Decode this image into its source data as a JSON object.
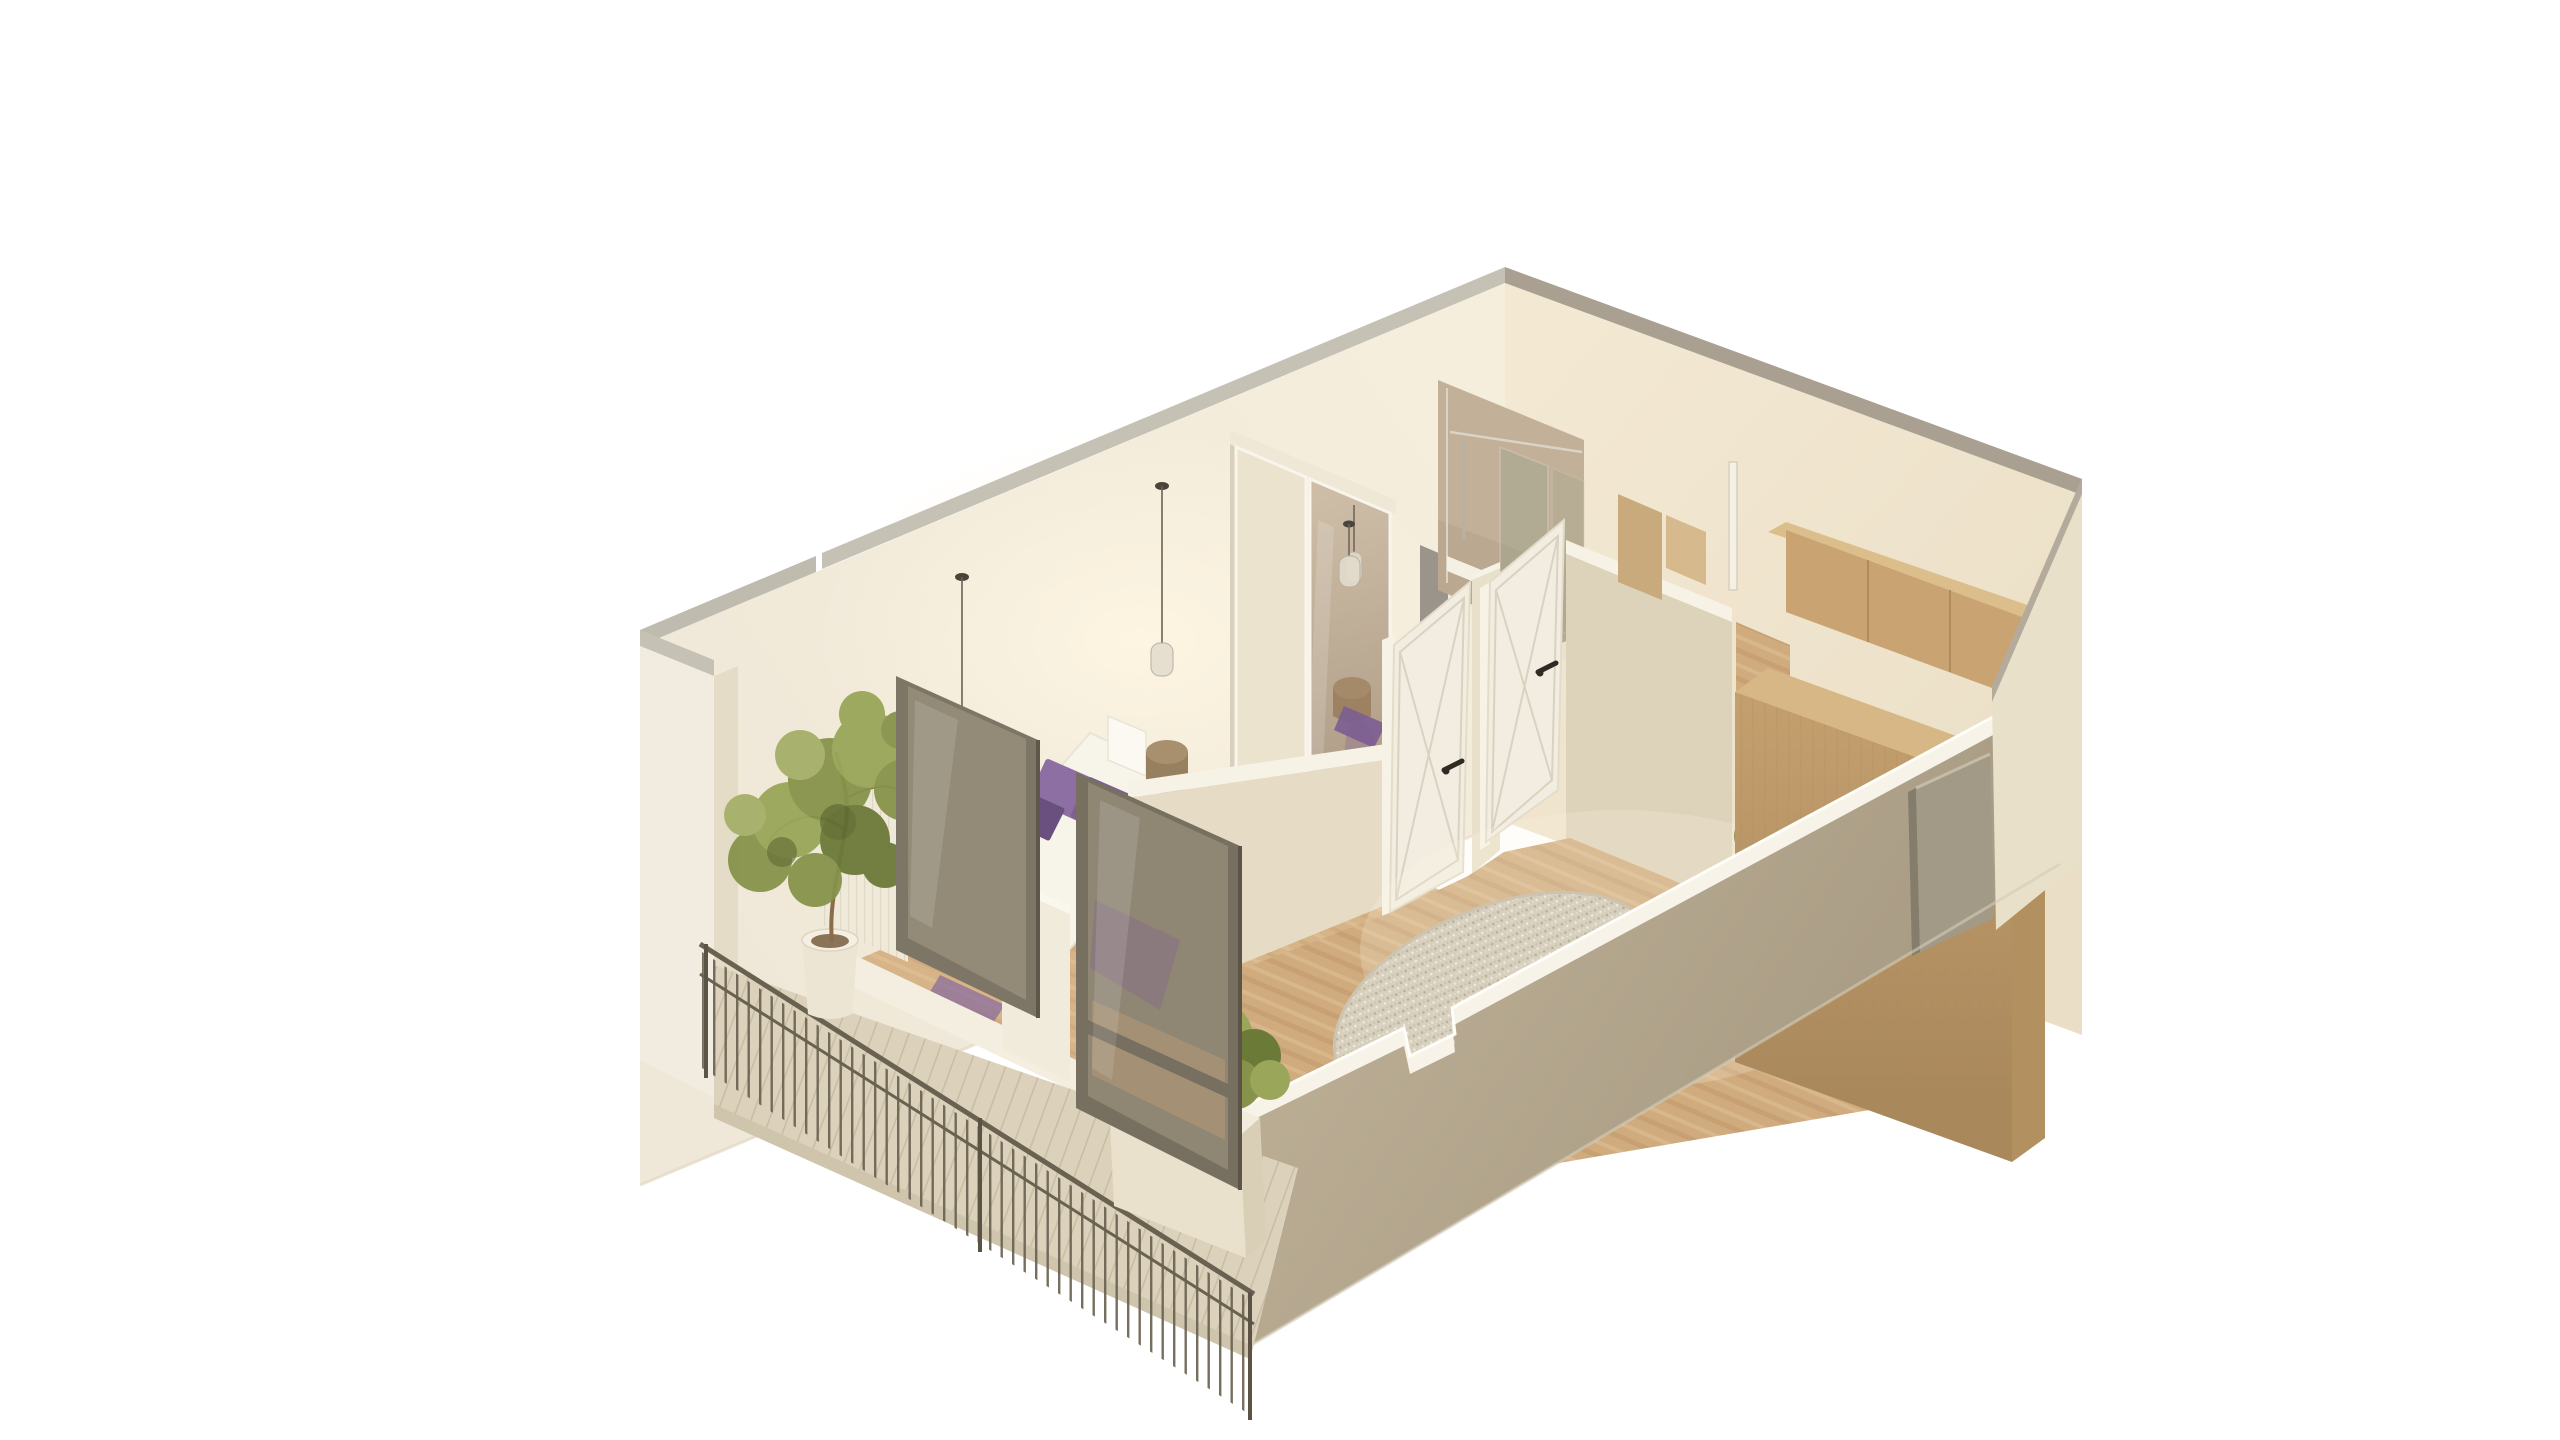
{
  "scene": {
    "description": "3D isometric cutaway floor-plan render of a studio apartment with balcony",
    "rooms": [
      "bedroom",
      "shower-room",
      "hallway",
      "living-kitchen",
      "balcony"
    ],
    "objects": [
      "double-bed-with-purple-pillows",
      "sliding-door-wardrobe-with-mirror",
      "pendant-lights",
      "glass-shower-enclosure",
      "white-cross-braced-doors",
      "oak-kitchen-cabinets",
      "round-boucle-rug",
      "balcony-railing",
      "potted-tree",
      "planter-box",
      "framed-glass-doors",
      "gray-entry-door",
      "round-pouf",
      "woven-basket"
    ]
  },
  "palette": {
    "background": "#ffffff",
    "wall_cut_gray": "#c6c1b5",
    "wall_cut_gray_dark": "#aaa092",
    "wall_cream_light": "#f5edda",
    "wall_cream": "#efe7d4",
    "wall_cream_warm": "#eee3cd",
    "wall_outer_bright": "#f1ecdf",
    "wall_shadow": "#ddd2ba",
    "partition_cream": "#e8dfc9",
    "partition_top_white": "#f7f3e8",
    "floor_wood": "#cfab7e",
    "floor_streak_dark": "#c0996b",
    "floor_streak_light": "#dcc094",
    "bedroom_floor": "#d6b488",
    "deck": "#dcd2bc",
    "deck_seam": "#c9bda4",
    "railing": "#6a6251",
    "railing_dark": "#5b5344",
    "glass_frame": "#7a7262",
    "glass_tint": "rgba(200,188,164,0.30)",
    "bed_white": "#f7f4ea",
    "pillow_purple": "#7e6093",
    "pillow_purple_dark": "#69507e",
    "throw_purple": "#7a5c90",
    "pouf_brown": "#a08566",
    "basket_tan": "#c7ae85",
    "wardrobe_door": "#ece3cf",
    "wardrobe_trim": "#f8f5ec",
    "mirror_top": "#cabaa4",
    "mirror_bottom": "#a5937d",
    "tile_tan": "#c2b098",
    "slab_gray": "#9b948a",
    "chrome": "#d9d4c6",
    "door_white": "#f2ede0",
    "door_line": "#d8d2c0",
    "handle_dark": "#2e2a24",
    "kitchen_top": "#d8b787",
    "kitchen_front": "#bf9c6a",
    "kitchen_front_dark": "#a9885c",
    "kitchen_upper": "#c9a371",
    "kitchen_upper_top": "#dcbe8d",
    "kitchen_seam": "#b08c5c",
    "rug_base": "#d8d0bf",
    "rug_dot_dark": "#b9af9b",
    "rug_dot_light": "#f0eadb",
    "plant_green": "#87934a",
    "plant_green_light": "#9aa65a",
    "plant_green_dark": "#6c7a38",
    "trunk_brown": "#8a6b4a",
    "pot_white": "#ece5d4",
    "pot_rim": "#f4efe2",
    "planter_cream": "#e9e1cc",
    "planter_side": "#d9cfb6",
    "facade_outer": "#b4a78e",
    "facade_corner_bright": "#e9e0ca",
    "facade_top_white": "#f7f3e9",
    "facade_edge_bright": "#fffdf8",
    "entry_door_gray": "#a29a86",
    "entry_door_shadow": "#857d6c",
    "glow": "#fff6e3"
  }
}
